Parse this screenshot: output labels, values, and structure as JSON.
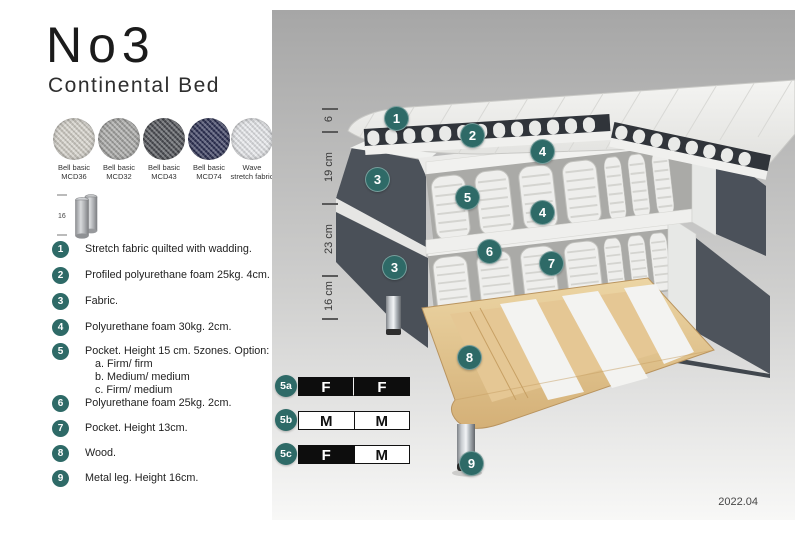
{
  "header": {
    "title": "No3",
    "subtitle": "Continental Bed"
  },
  "swatches": [
    {
      "name": "Bell basic",
      "code": "MCD36",
      "color": "#d6d3cb"
    },
    {
      "name": "Bell basic",
      "code": "MCD32",
      "color": "#a9a9a7"
    },
    {
      "name": "Bell basic",
      "code": "MCD43",
      "color": "#4f5157"
    },
    {
      "name": "Bell basic",
      "code": "MCD74",
      "color": "#303458"
    },
    {
      "name": "Wave",
      "code": "stretch fabric",
      "color": "#e9ebee"
    }
  ],
  "leg_icon": {
    "height_label": "16"
  },
  "legend": [
    {
      "num": "1",
      "text": "Stretch fabric quilted with wadding."
    },
    {
      "num": "2",
      "text": "Profiled polyurethane foam 25kg. 4cm."
    },
    {
      "num": "3",
      "text": "Fabric."
    },
    {
      "num": "4",
      "text": "Polyurethane foam 30kg. 2cm."
    },
    {
      "num": "5",
      "text": "Pocket. Height 15 cm. 5zones. Option:",
      "options": [
        "a. Firm/ firm",
        "b. Medium/ medium",
        "c. Firm/ medium"
      ]
    },
    {
      "num": "6",
      "text": "Polyurethane foam 25kg. 2cm."
    },
    {
      "num": "7",
      "text": "Pocket. Height 13cm."
    },
    {
      "num": "8",
      "text": "Wood."
    },
    {
      "num": "9",
      "text": "Metal leg. Height 16cm."
    }
  ],
  "diagram": {
    "accent_color": "#2e6a67",
    "measurements": [
      "6",
      "19 cm",
      "23 cm",
      "16 cm"
    ],
    "callouts": [
      "1",
      "2",
      "3",
      "4",
      "5",
      "6",
      "7",
      "8",
      "9"
    ],
    "firmness_options": [
      {
        "label": "5a",
        "cells": [
          {
            "text": "F",
            "filled": true
          },
          {
            "text": "F",
            "filled": true
          }
        ]
      },
      {
        "label": "5b",
        "cells": [
          {
            "text": "M",
            "filled": false
          },
          {
            "text": "M",
            "filled": false
          }
        ]
      },
      {
        "label": "5c",
        "cells": [
          {
            "text": "F",
            "filled": true
          },
          {
            "text": "M",
            "filled": false
          }
        ]
      }
    ],
    "version": "2022.04"
  }
}
